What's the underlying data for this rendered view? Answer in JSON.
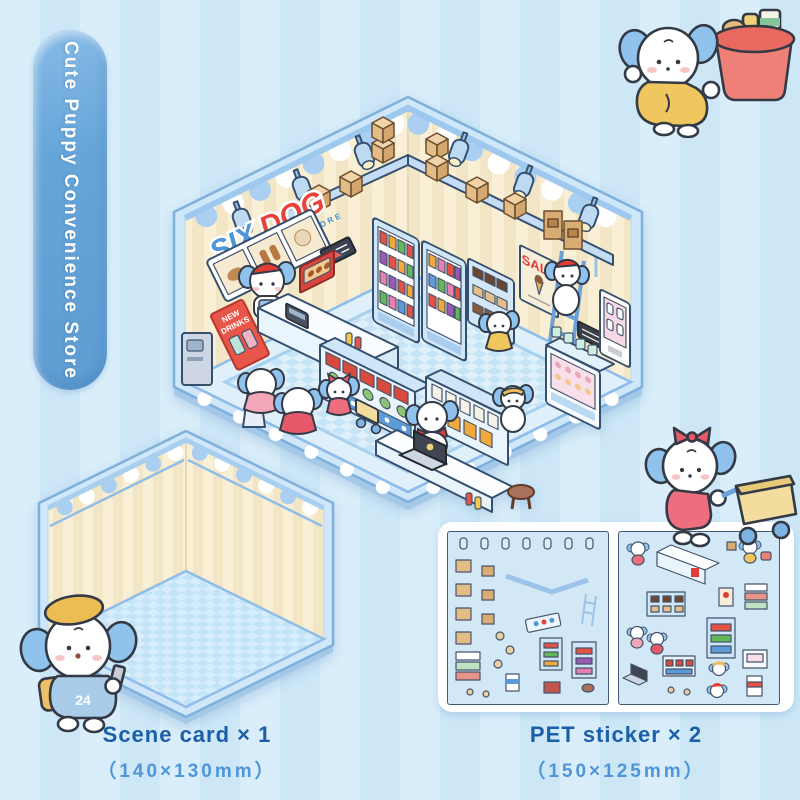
{
  "badge": {
    "text": "Cute Puppy Convenience Store",
    "bg_color": "#66a5d9",
    "text_color": "#ffffff"
  },
  "store": {
    "sign_word1": "SIX",
    "sign_word2": "DOG",
    "sign_subtitle": "CONVENIENCE STORE",
    "sale_text": "SALE",
    "counter_number": "6",
    "poster_line1": "NEW",
    "poster_line2": "DRINKS"
  },
  "scene_card": {
    "label": "Scene card × 1",
    "size": "（140×130mm）",
    "puppy_vest_number": "24"
  },
  "pet_sticker": {
    "label": "PET sticker × 2",
    "size": "（150×125mm）"
  },
  "characters": {
    "top_right": "puppy-pushing-shopping-basket",
    "bottom_left": "puppy-with-beret-and-backpack",
    "right": "puppy-with-bow-pushing-cart"
  },
  "colors": {
    "background_stripe_a": "#d9eefa",
    "background_stripe_b": "#cde7f7",
    "card_frame": "#cfe7f8",
    "card_outline": "#7fb0dd",
    "wall_cream": "#f9efd5",
    "wall_stripe": "#f3e6c6",
    "awning_blue": "#aacff0",
    "floor_blue": "#dff0fb",
    "floor_check": "#c7e4f6",
    "accent_red": "#e23c36",
    "label_dark_blue": "#1b5fa8",
    "label_light_blue": "#4e96d8",
    "puppy_ear_blue": "#8fc2ec",
    "clothes_yellow": "#f0c75e",
    "clothes_pink": "#ed6e7e"
  }
}
